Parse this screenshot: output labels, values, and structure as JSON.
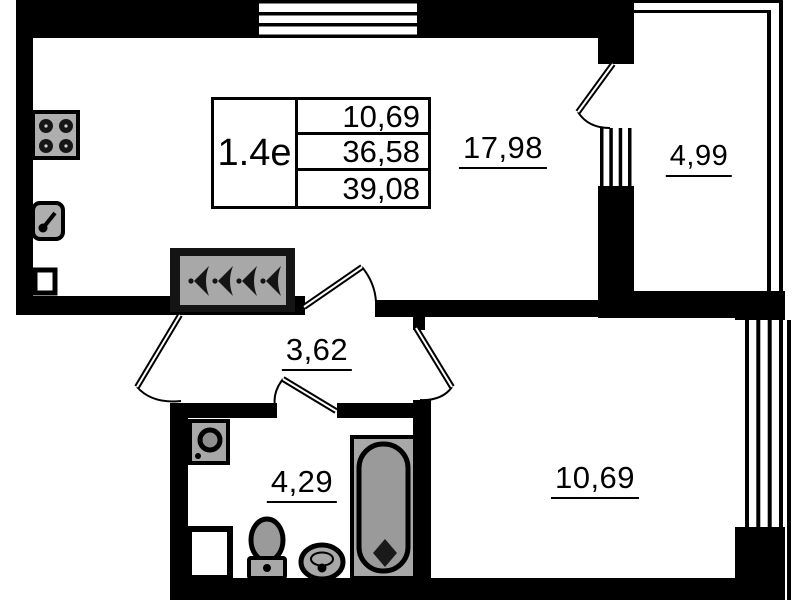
{
  "plan": {
    "title_block": {
      "unit_label": "1.4e",
      "values": [
        "10,69",
        "36,58",
        "39,08"
      ]
    },
    "rooms": [
      {
        "id": "living-kitchen",
        "area": "17,98"
      },
      {
        "id": "balcony",
        "area": "4,99"
      },
      {
        "id": "hallway",
        "area": "3,62"
      },
      {
        "id": "bathroom",
        "area": "4,29"
      },
      {
        "id": "bedroom",
        "area": "10,69"
      }
    ],
    "icons": {
      "stove-icon": "4-burner cooktop",
      "kitchen-sink-icon": "sink with faucet",
      "wardrobe-hangers-icon": "4 clothes hangers",
      "washing-machine-icon": "front-load washer",
      "toilet-icon": "toilet top view",
      "washbasin-icon": "round basin",
      "bathtub-icon": "bathtub with drain",
      "window-icon": "hatched window",
      "door-swing-icon": "door leaf with arc"
    },
    "colors": {
      "wall": "#000000",
      "fixture_gray": "#a8a8a8",
      "background": "#ffffff"
    }
  }
}
